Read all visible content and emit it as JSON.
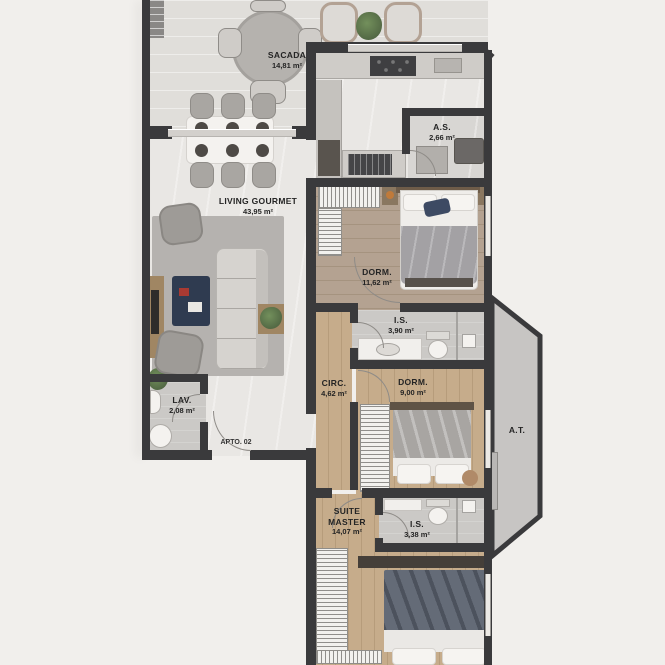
{
  "title": "Apartment floor plan",
  "apartment_label": "APTO. 02",
  "rooms": [
    {
      "name": "SACADA",
      "area": "14,81 m²"
    },
    {
      "name": "A.S.",
      "area": "2,66 m²"
    },
    {
      "name": "LIVING GOURMET",
      "area": "43,95 m²"
    },
    {
      "name": "DORM.",
      "area": "11,62 m²"
    },
    {
      "name": "I.S.",
      "area": "3,90 m²"
    },
    {
      "name": "CIRC.",
      "area": "4,62 m²"
    },
    {
      "name": "DORM.",
      "area": "9,00 m²"
    },
    {
      "name": "A.T.",
      "area": ""
    },
    {
      "name": "LAV.",
      "area": "2,08 m²"
    },
    {
      "name": "SUITE MASTER",
      "area": "14,07 m²"
    },
    {
      "name": "I.S.",
      "area": "3,38 m²"
    }
  ],
  "colors": {
    "wall": "#3a3a3c",
    "wood_floor": "#c2a888",
    "wood_floor_gray": "#b2a08f",
    "tile_floor": "#e9e7e4",
    "bath_floor": "#cbc9c6",
    "at_fill": "#c7c5c3",
    "background": "#f1efec",
    "accent_navy": "#3d4a63",
    "plant_green": "#5f7b4d"
  }
}
